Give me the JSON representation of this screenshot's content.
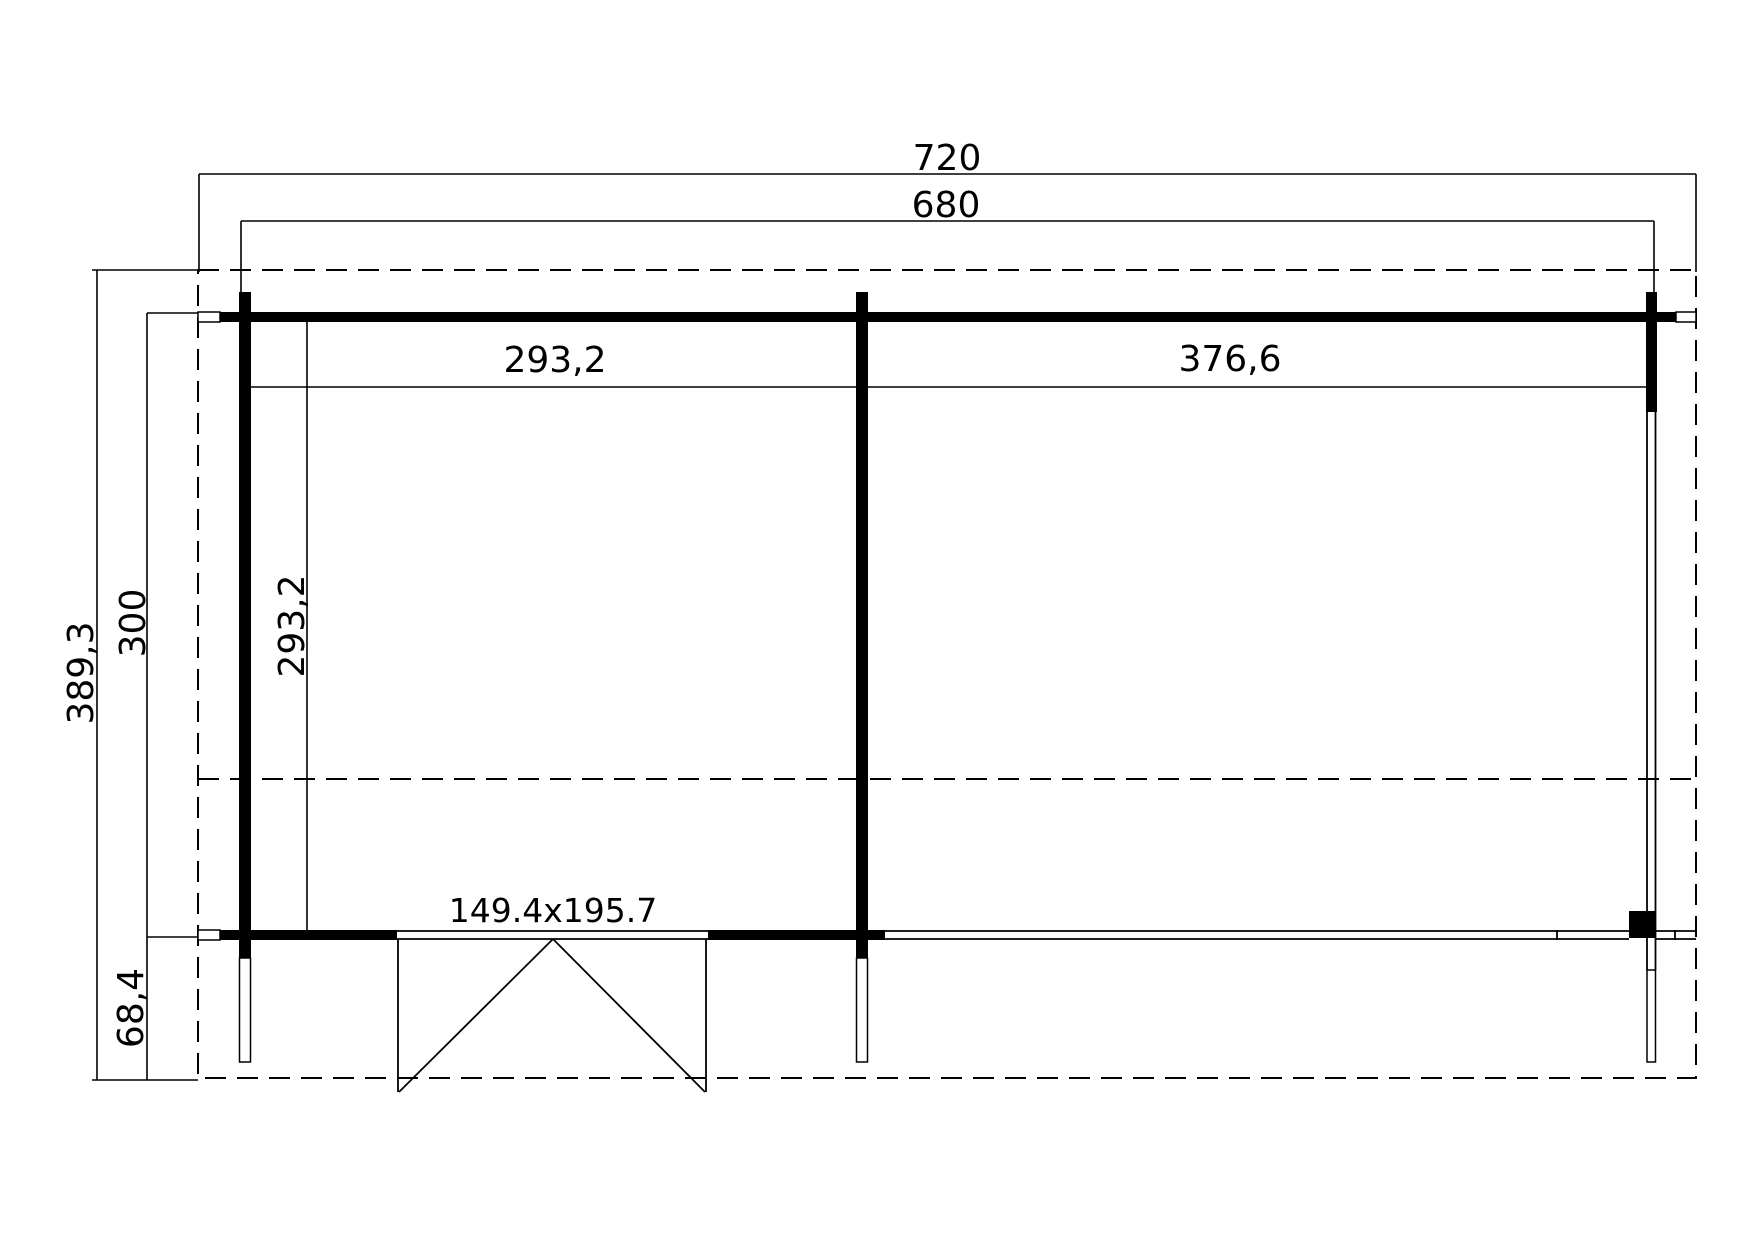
{
  "drawing": {
    "type": "floor-plan",
    "background_color": "#ffffff",
    "line_color": "#000000",
    "labels": {
      "total_width": "720",
      "outer_wall_width": "680",
      "total_depth": "389,3",
      "main_depth": "300",
      "overhang_depth": "68,4",
      "left_room_width": "293,2",
      "left_room_depth": "293,2",
      "right_room_width": "376,6",
      "door_dimensions": "149.4x195.7"
    }
  }
}
